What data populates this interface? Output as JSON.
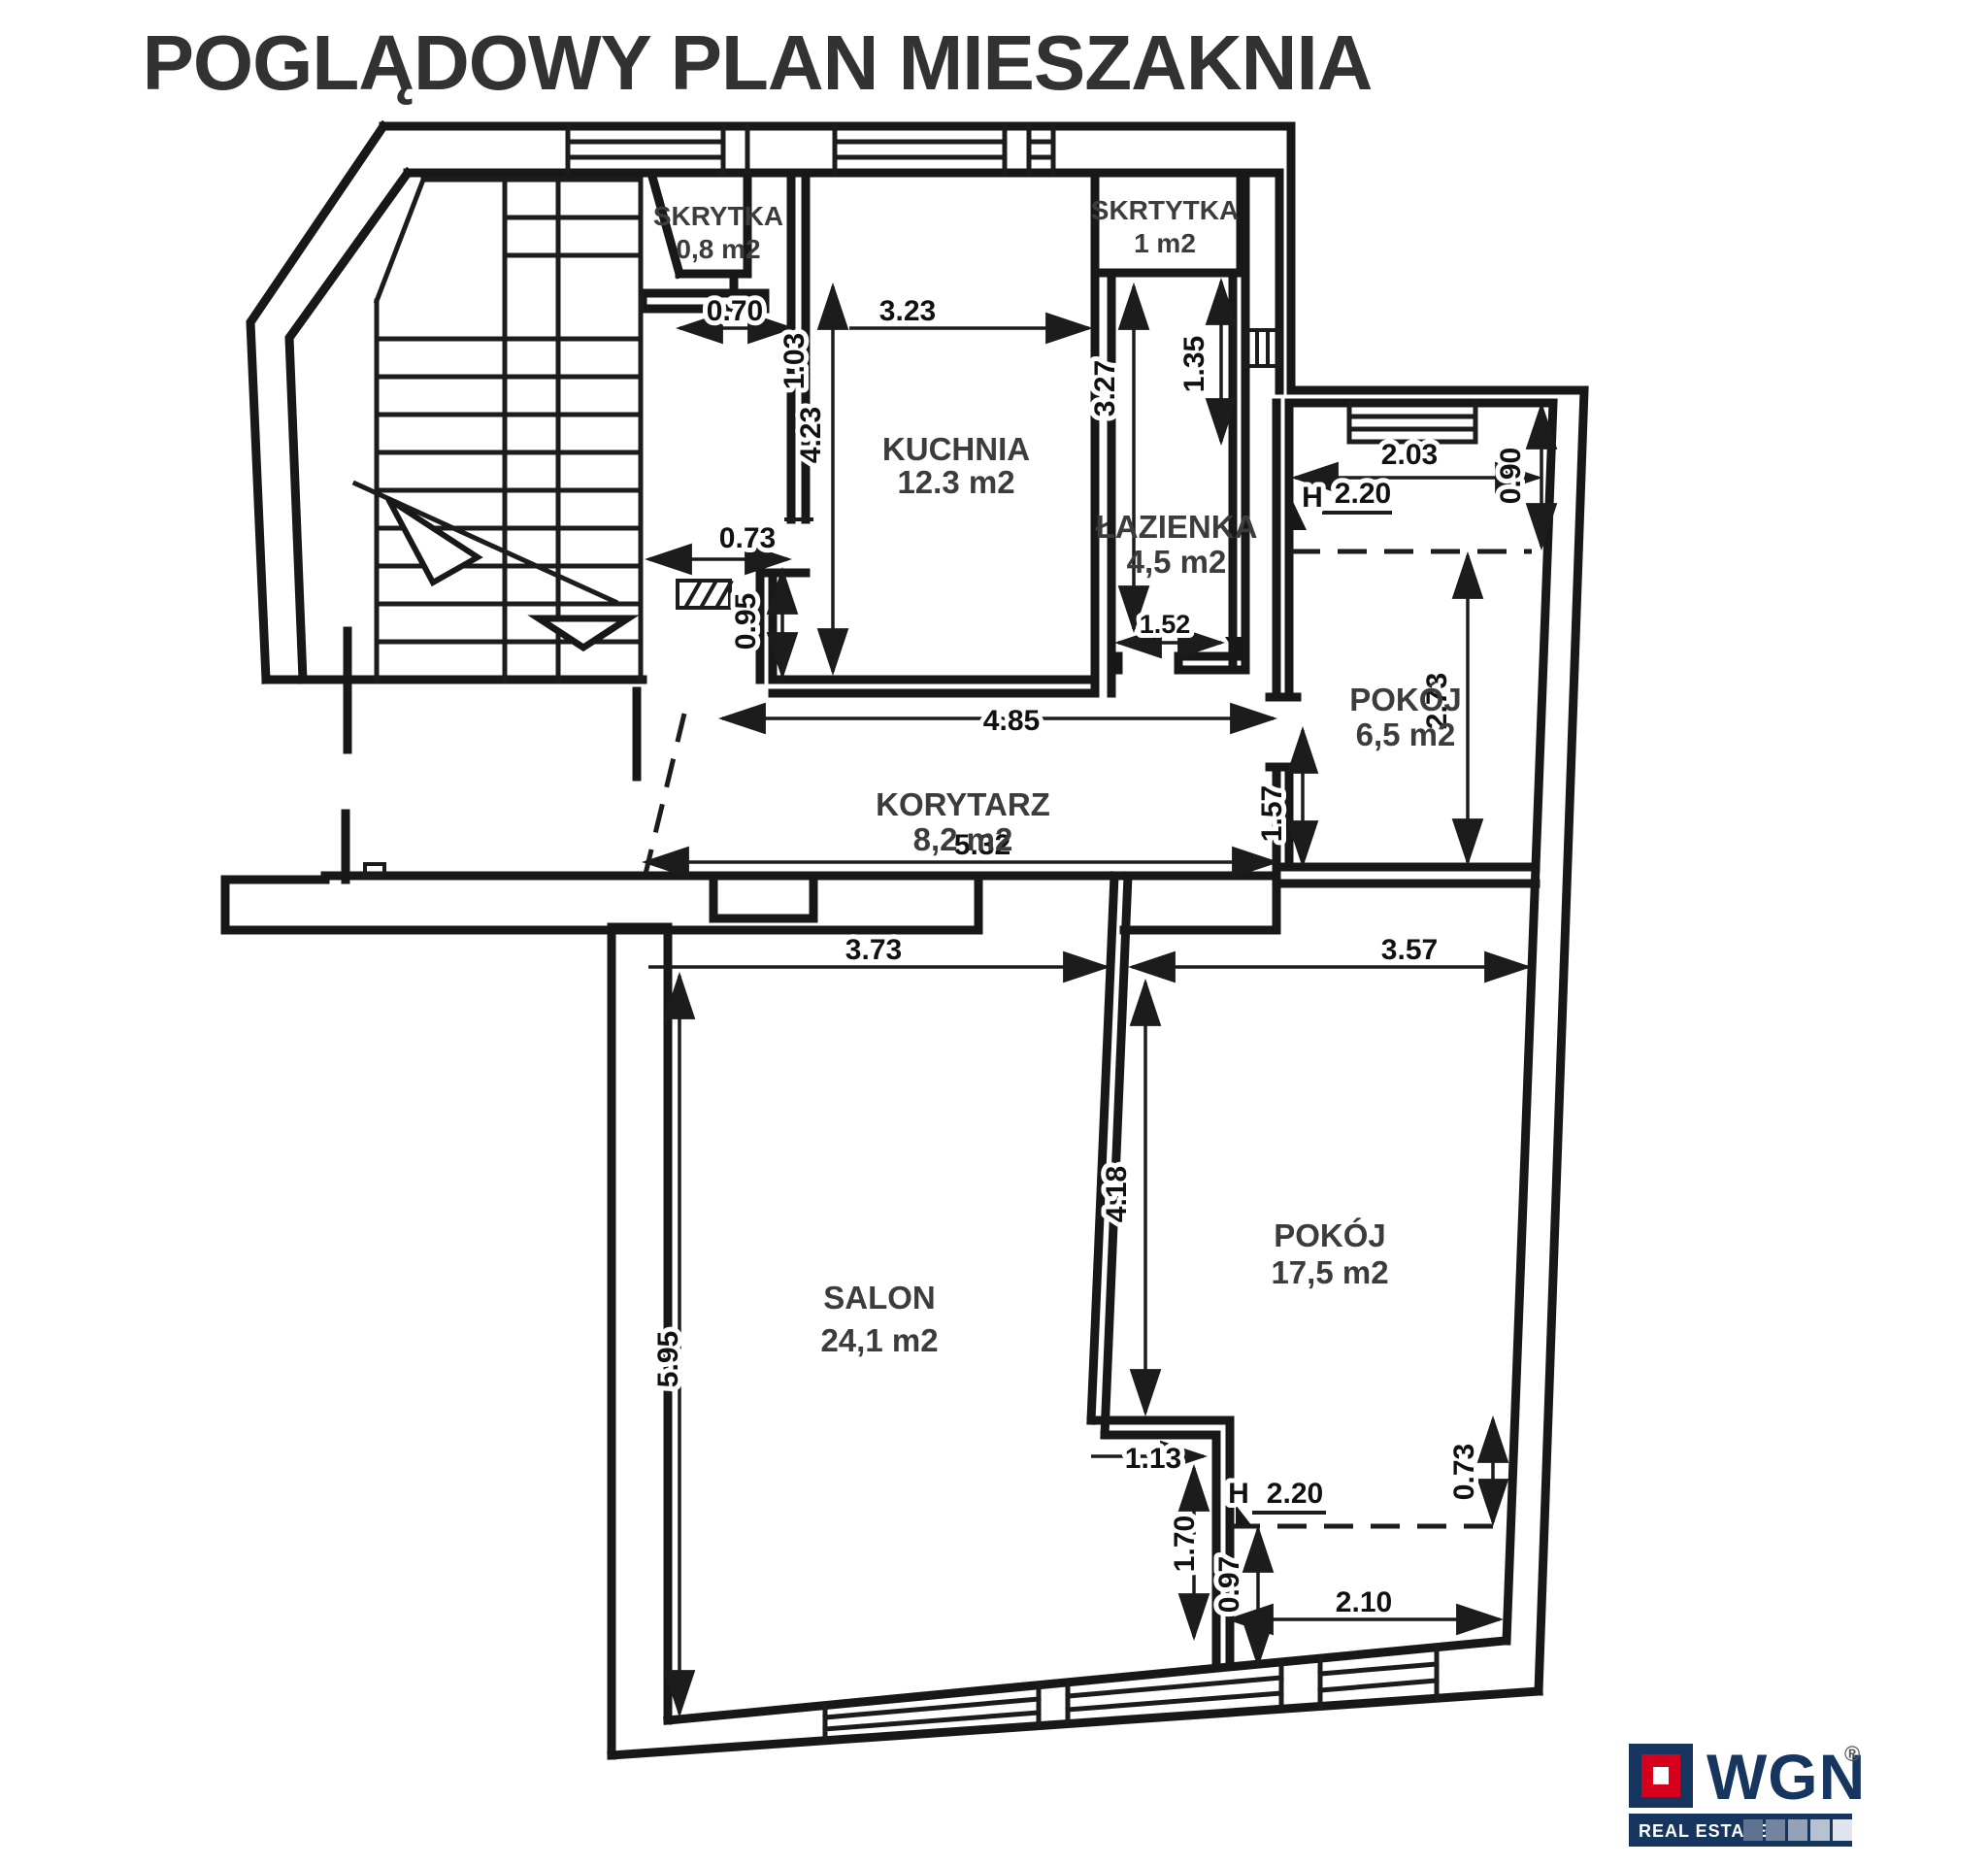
{
  "title": "POGLĄDOWY PLAN MIESZAKNIA",
  "rooms": {
    "skrytka1": {
      "name": "SKRYTKA",
      "area": "0,8 m2"
    },
    "skrytka2": {
      "name": "SKRTYTKA",
      "area": "1 m2"
    },
    "kuchnia": {
      "name": "KUCHNIA",
      "area": "12.3 m2"
    },
    "lazienka": {
      "name": "ŁAZIENKA",
      "area": "4,5 m2"
    },
    "pokoj_maly": {
      "name": "POKÓJ",
      "area": "6,5 m2"
    },
    "korytarz": {
      "name": "KORYTARZ",
      "area": "8,2 m2"
    },
    "salon": {
      "name": "SALON",
      "area": "24,1 m2"
    },
    "pokoj_duzy": {
      "name": "POKÓJ",
      "area": "17,5 m2"
    }
  },
  "dims": {
    "d070": "0.70",
    "d323": "3.23",
    "d103": "1.03",
    "d423": "4.23",
    "d073a": "0.73",
    "d095": "0.95",
    "d485": "4.85",
    "d327": "3.27",
    "d135": "1.35",
    "d152": "1.52",
    "d203": "2.03",
    "d090": "0.90",
    "d273": "2.73",
    "d157": "1.57",
    "d532": "5.32",
    "d373": "3.73",
    "d357": "3.57",
    "d595": "5.95",
    "d418": "4.18",
    "d113": "1.13",
    "d170": "1.70",
    "d097": "0.97",
    "d210": "2.10",
    "d073b": "0.73",
    "h_label": "H",
    "h220a": "2.20",
    "h220b": "2.20"
  },
  "logo": {
    "brand": "WGN",
    "registered": "®",
    "tagline": "REAL ESTATE"
  },
  "colors": {
    "ink": "#181818",
    "label": "#3c3c3e",
    "navy": "#16355f",
    "red": "#d6001c"
  }
}
